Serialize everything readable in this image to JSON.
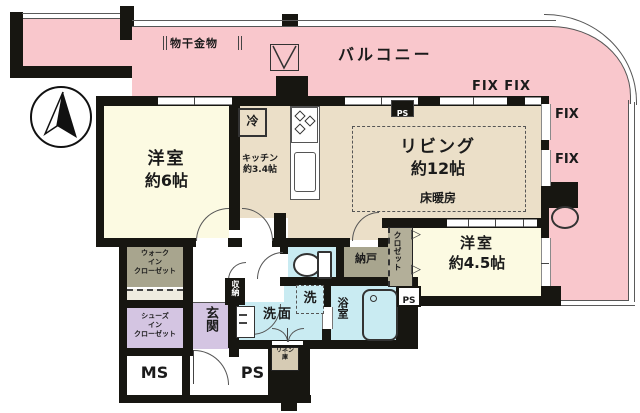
{
  "title": "マンション間取り図",
  "colors": {
    "balcony": "#f9c7cc",
    "western_room": "#fcfae2",
    "living_kitchen": "#ebdfc8",
    "wet_area": "#c9ebf2",
    "entrance": "#d4c5e2",
    "closet_olive": "#a8a58e",
    "wall": "#171611"
  },
  "icons": {
    "bifold_door": "▷"
  },
  "balcony": {
    "label": "バルコニー",
    "laundry_hook": "物干金物",
    "fix_pair": "FIX FIX",
    "fix_mid": "FIX",
    "fix_low": "FIX"
  },
  "rooms": {
    "western6": {
      "name": "洋室",
      "size": "約6帖"
    },
    "kitchen": {
      "name": "キッチン",
      "size": "約3.4帖"
    },
    "living": {
      "name": "リビング",
      "size": "約12帖",
      "floor_heating": "床暖房"
    },
    "western45": {
      "name": "洋室",
      "size": "約4.5帖"
    },
    "bath": "浴室",
    "powder": "洗面",
    "laundry": "洗",
    "storage_room": "納戸",
    "closet": "クロゼット",
    "walk_in_closet": [
      "ウォーク",
      "イン",
      "クローゼット"
    ],
    "shoes_closet": [
      "シューズ",
      "イン",
      "クローゼット"
    ],
    "storage": "収納",
    "linen": [
      "リネン",
      "庫"
    ],
    "entrance": "玄関",
    "fridge": "冷"
  },
  "shafts": {
    "ms": "MS",
    "ps_bottom": "PS",
    "ps_living": "PS",
    "ps_bath": "PS"
  }
}
